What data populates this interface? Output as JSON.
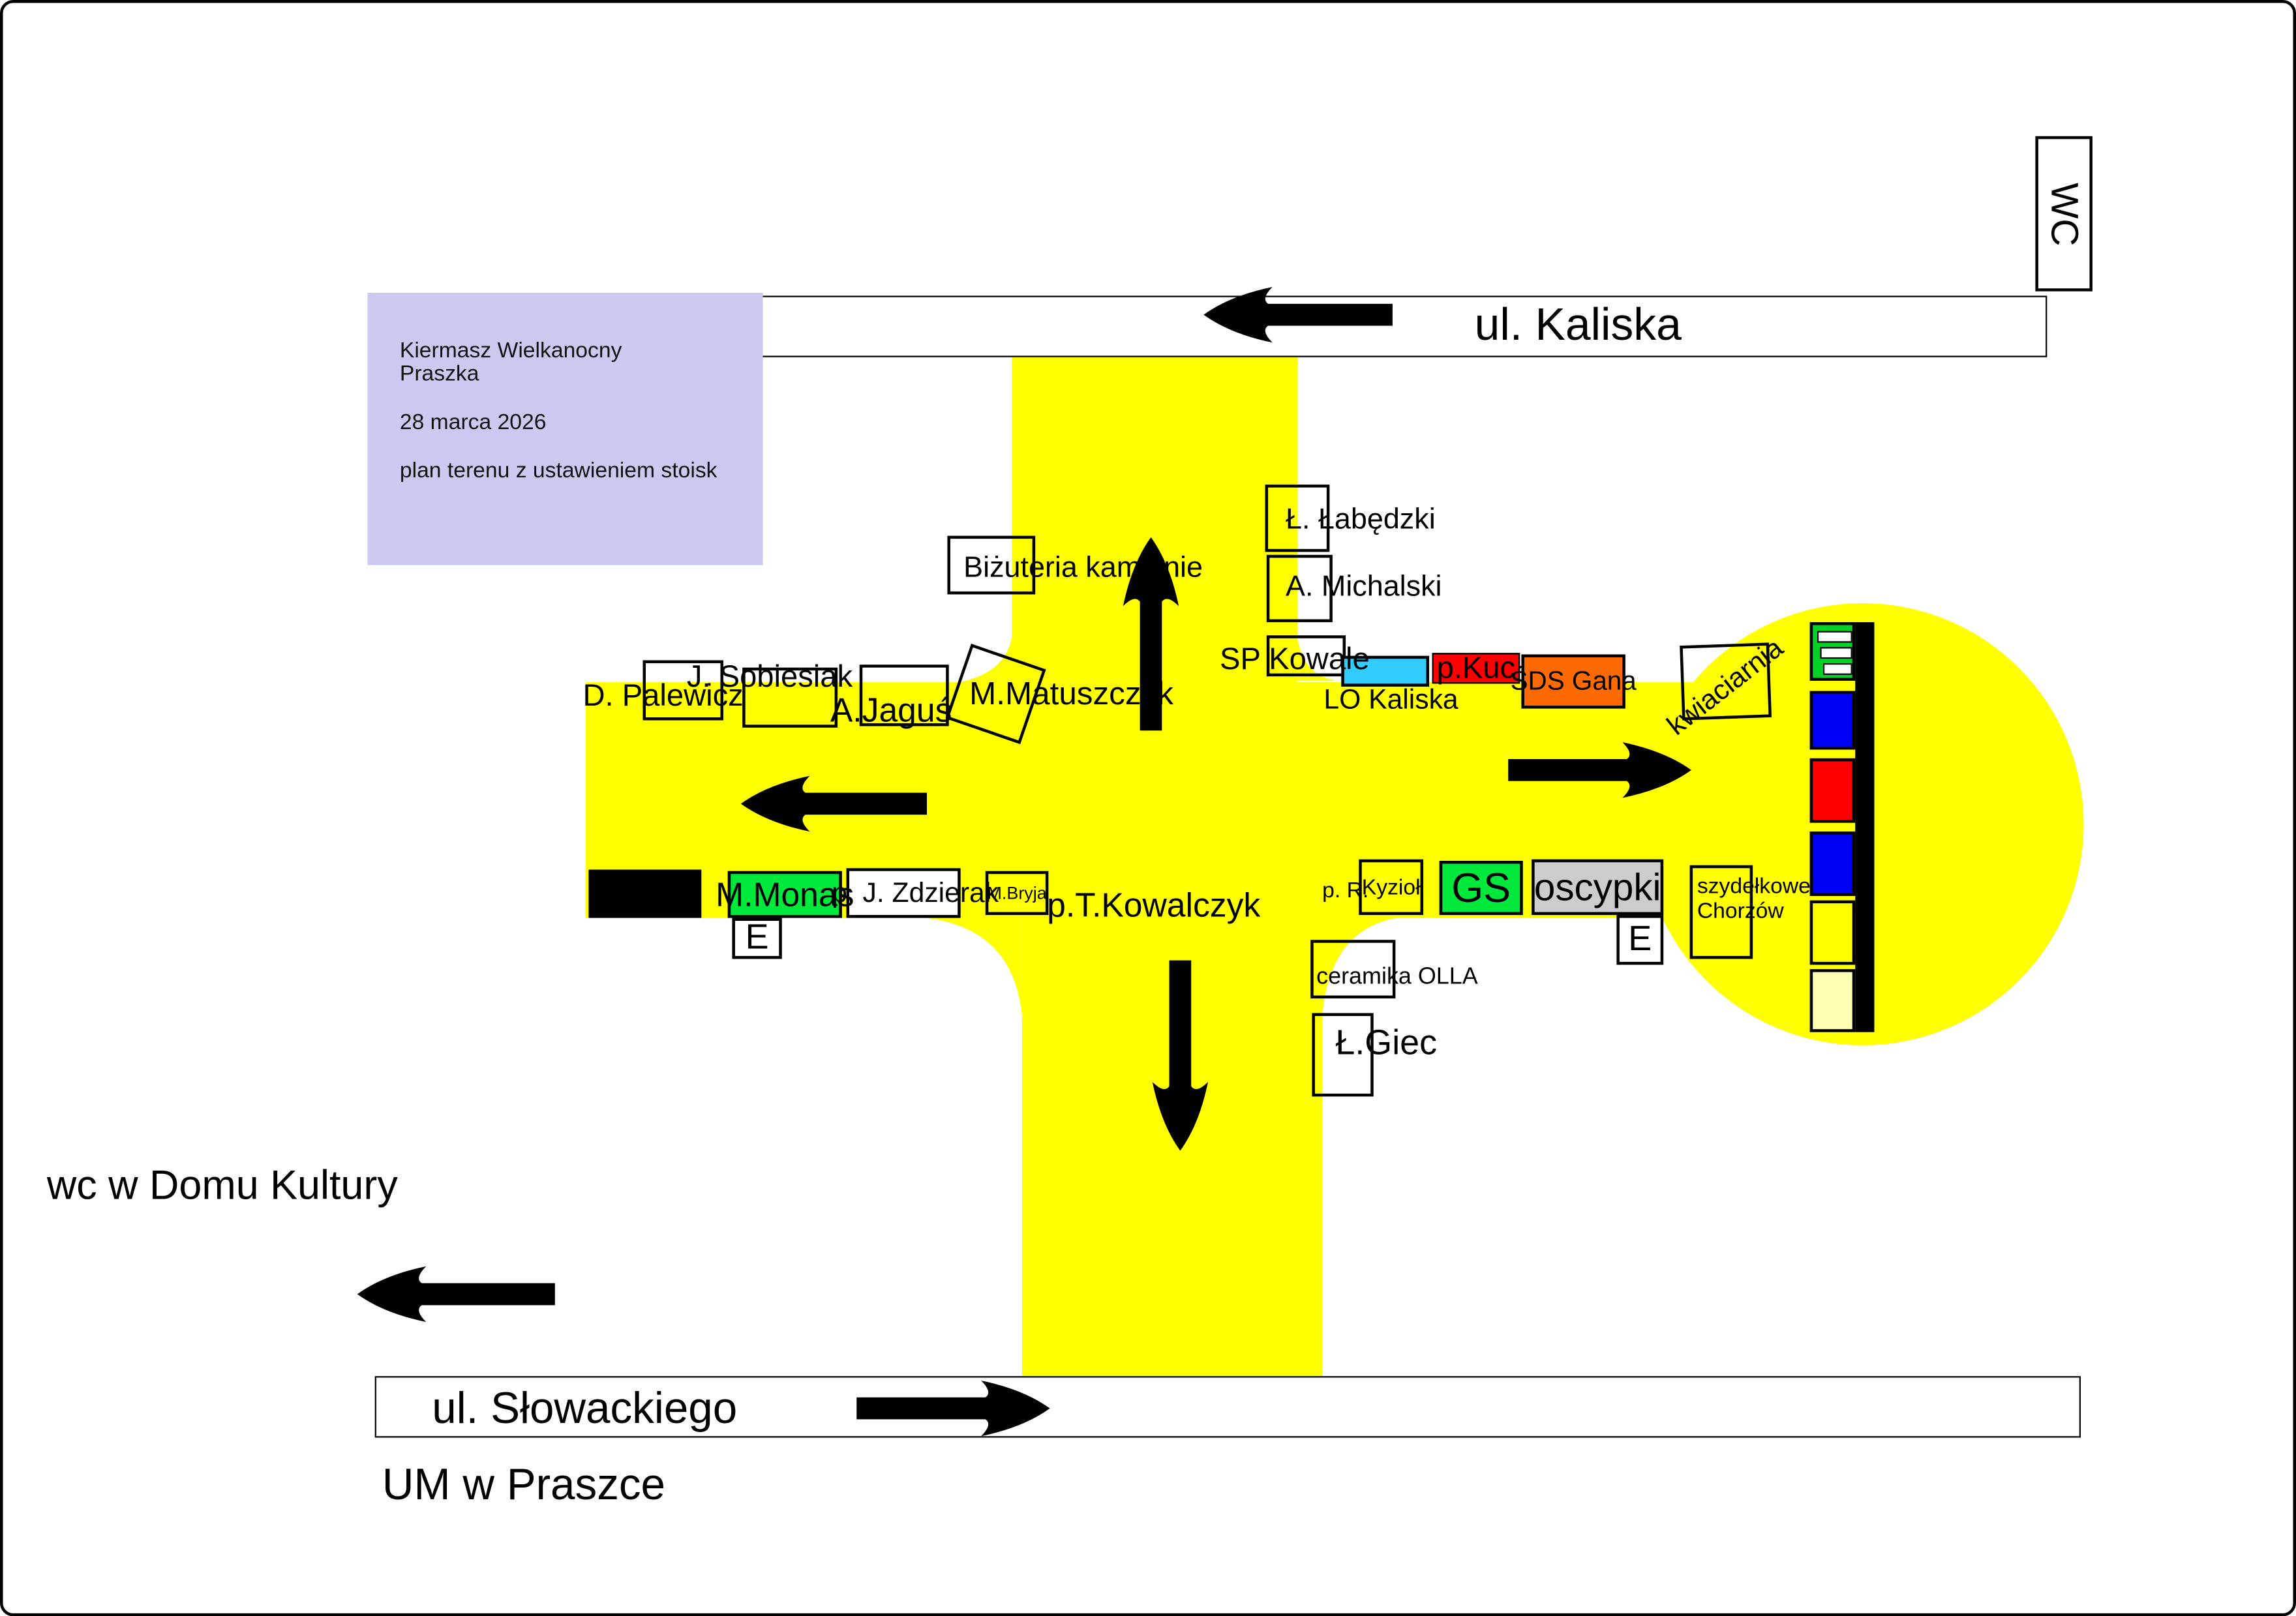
{
  "info_box": {
    "title_line1": "Kiermasz Wielkanocny",
    "title_line2": "Praszka",
    "date": "28 marca 2026",
    "subtitle": "plan terenu z ustawieniem stoisk"
  },
  "streets": {
    "kaliska": "ul. Kaliska",
    "slowackiego": "ul. Słowackiego"
  },
  "places": {
    "wc_booth": "WC",
    "wc_note": "wc w Domu Kultury",
    "town_hall": "UM w Praszce"
  },
  "stalls": {
    "labedzki": "Ł. Łabędzki",
    "michalski": "A. Michalski",
    "sp_kowale": "SP Kowale",
    "lo_kaliska": "LO Kaliska",
    "kuc": "p.Kuc",
    "sds_gana": "ŚDS Gana",
    "kwiaciarnia": "kwiaciarnia",
    "bizuteria": "Biżuteria kamienie",
    "palewicz": "D. Palewicz",
    "sobiesiak": "J. Sobiesiak",
    "jagus": "A.Jaguś",
    "matuszczyk": "M.Matuszczyk",
    "monas": "M.Monas",
    "e_left": "E",
    "zdzierak": "p. J. Zdzierak",
    "bryja": "M.Bryja",
    "kowalczyk": "p.T.Kowalczyk",
    "kyziol_prefix": "p. R.",
    "kyziol": "Kyzioł",
    "gs": "GS",
    "oscypki": "oscypki",
    "e_right": "E",
    "szydelkowe_line1": "szydełkowe",
    "szydelkowe_line2": "Chorzów",
    "ceramika": "ceramika OLLA",
    "giec": "Ł.Giec"
  },
  "colors": {
    "yellow": "#FFFF00",
    "lavender": "#CACAF1",
    "cyan": "#33CCFF",
    "red": "#FF0000",
    "orange": "#FF6A00",
    "green_bright": "#00E83C",
    "green_dark": "#00D226",
    "blue": "#0000F5",
    "gray": "#CCCCCC",
    "pale_yellow": "#FFFFB4",
    "black": "#000000"
  }
}
